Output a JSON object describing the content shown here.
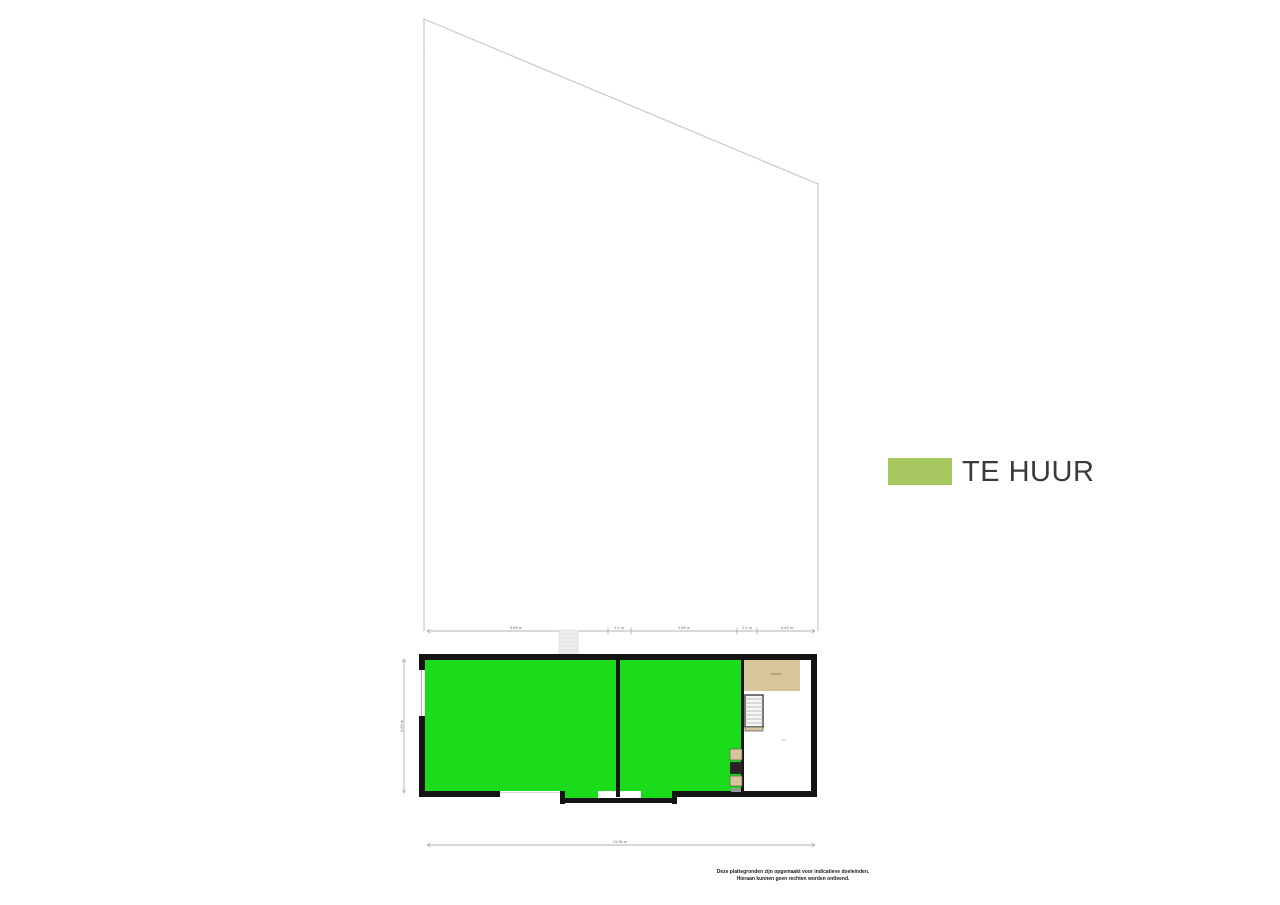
{
  "legend": {
    "label": "TE HUUR"
  },
  "floorplan": {
    "top_dimensions": [
      "9,68 m",
      "1,1 m",
      "2,98 m",
      "1,1 m",
      "4,63 m"
    ],
    "total_width": "19,96 m",
    "left_height": "6,96 m",
    "labels": {
      "entree": "entree",
      "hall": "wc"
    }
  },
  "disclaimer": {
    "line1": "Deze plattegronden zijn opgemaakt voor indicatieve doeleinden.",
    "line2": "Hieraan kunnen geen rechten worden ontleend."
  },
  "colors": {
    "available_area": "#1adc1a",
    "legend_swatch": "#a6c75f",
    "wall": "#141414",
    "plot_outline": "#c9c9c9",
    "entree_floor": "#d9c59b",
    "dimension_line": "#9a9a9a"
  }
}
